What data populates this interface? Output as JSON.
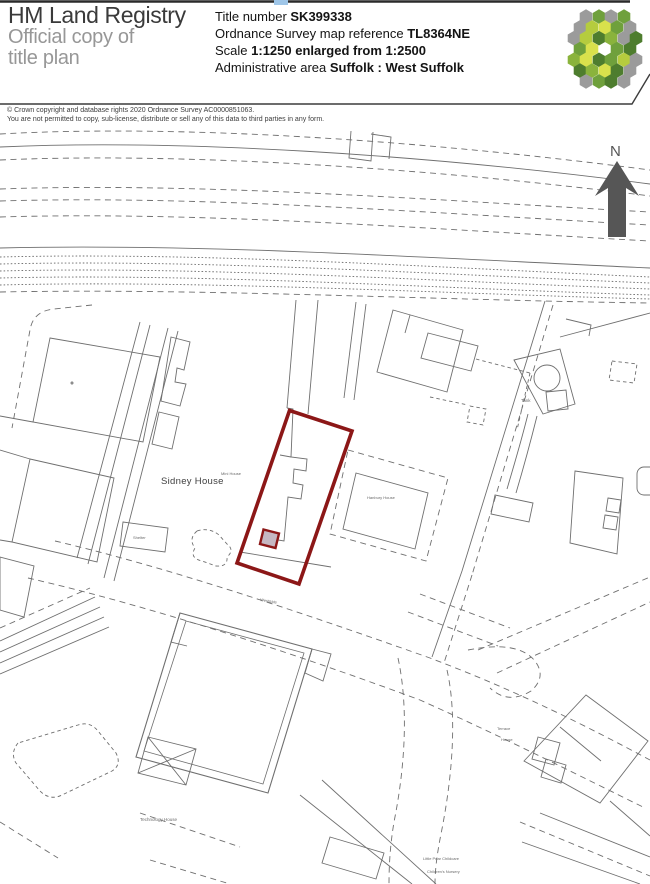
{
  "header": {
    "brand": {
      "line1": "HM Land Registry",
      "line2": "Official copy of",
      "line3": "title plan"
    },
    "fields": [
      {
        "label": "Title number ",
        "value": "SK399338"
      },
      {
        "label": "Ordnance Survey map reference ",
        "value": "TL8364NE"
      },
      {
        "label": "Scale ",
        "value": "1:1250 enlarged from 1:2500"
      },
      {
        "label": "Administrative area ",
        "value": "Suffolk : West Suffolk"
      }
    ]
  },
  "copyright": {
    "line1": "© Crown copyright and database rights 2020 Ordnance Survey AC0000851063.",
    "line2": "You are not permitted to copy, sub-license, distribute or sell any of this data to third parties in any form."
  },
  "map": {
    "north_label": "N",
    "labels": {
      "sidney_house": "Sidney House",
      "small_house": "Mini House",
      "hanbury_house": "Hanbury House",
      "shelter": "Shelter",
      "tank": "Tank",
      "road": "Westgate",
      "technology_house": "Technology House",
      "terrace_house_line1": "Terrace",
      "terrace_house_line2": "House",
      "childcare_line1": "Little Pear Childcare",
      "childcare_line2": "Children's Nursery"
    },
    "colors": {
      "boundary_red": "#8c1717",
      "line_gray": "#6f6f6f",
      "arrow_gray": "#565656",
      "logo_green_dark": "#4e7d2e",
      "logo_green": "#6fa03c",
      "logo_lime": "#b5cc3e",
      "logo_yellow": "#d9e14c",
      "logo_gray": "#9b9b9b"
    }
  }
}
